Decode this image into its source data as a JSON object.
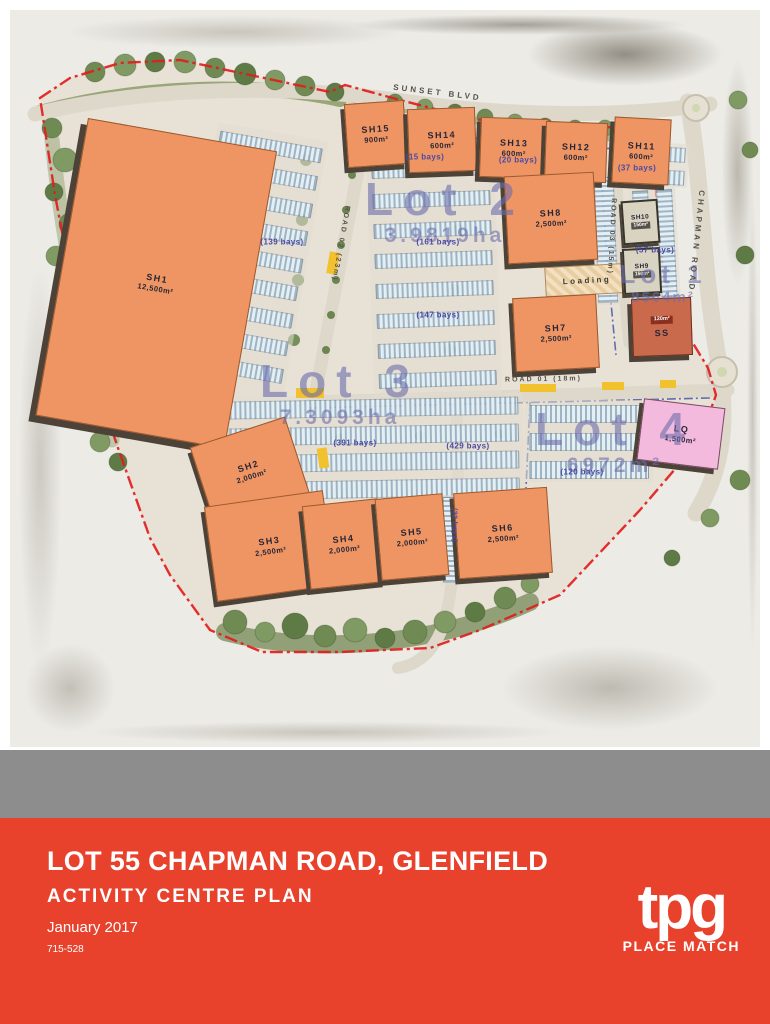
{
  "map": {
    "streets": {
      "sunset": "SUNSET BLVD",
      "chapman": "CHAPMAN ROAD",
      "road01": "ROAD 01 (18m)",
      "road02": "ROAD 02 (23m)",
      "road03": "ROAD 03 (15m)"
    },
    "lots": [
      {
        "name": "Lot 2",
        "area": "3.9819ha"
      },
      {
        "name": "Lot 3",
        "area": "7.3093ha"
      },
      {
        "name": "Lot 4",
        "area": "6972m²"
      },
      {
        "name": "Lot 1",
        "area": "8564m²"
      }
    ],
    "buildings": [
      {
        "id": "SH1",
        "area": "12,500m²"
      },
      {
        "id": "SH15",
        "area": "900m²"
      },
      {
        "id": "SH14",
        "area": "600m²"
      },
      {
        "id": "SH13",
        "area": "600m²"
      },
      {
        "id": "SH12",
        "area": "600m²"
      },
      {
        "id": "SH11",
        "area": "600m²"
      },
      {
        "id": "SH8",
        "area": "2,500m²"
      },
      {
        "id": "SH7",
        "area": "2,500m²"
      },
      {
        "id": "SH10",
        "area": "150m²"
      },
      {
        "id": "SH9",
        "area": "150m²"
      },
      {
        "id": "SS",
        "area": "120m²"
      },
      {
        "id": "SH2",
        "area": "2,000m²"
      },
      {
        "id": "SH3",
        "area": "2,500m²"
      },
      {
        "id": "SH4",
        "area": "2,000m²"
      },
      {
        "id": "SH5",
        "area": "2,000m²"
      },
      {
        "id": "SH6",
        "area": "2,500m²"
      },
      {
        "id": "LQ",
        "area": "1,500m²"
      }
    ],
    "loading_label": "Loading",
    "parking": {
      "sunset_west": "(15 bays)",
      "sunset_east": "(20 bays)",
      "northeast": "(37 bays)",
      "sh1_east": "(139 bays)",
      "lot2_upper": "(161 bays)",
      "lot2_lower": "(147 bays)",
      "lot1": "(57 bays)",
      "lot3": "(391 bays)",
      "lot3_east": "(429 bays)",
      "lot4": "(120 bays)",
      "sh6_west": "(32 bays)"
    }
  },
  "footer": {
    "title": "LOT 55 CHAPMAN ROAD, GLENFIELD",
    "subtitle": "ACTIVITY CENTRE PLAN",
    "date": "January 2017",
    "ref": "715-528",
    "logo": {
      "brand": "tpg",
      "tagline": "PLACE MATCH"
    }
  },
  "colors": {
    "footer_red": "#e8422d",
    "band_grey": "#8d8d8d",
    "building_orange": "#ef9563",
    "lq_pink": "#f3badd",
    "boundary_red": "#e11d1d",
    "lot_text_blue": "#6a6cac",
    "parking_blue": "#86a6be"
  }
}
